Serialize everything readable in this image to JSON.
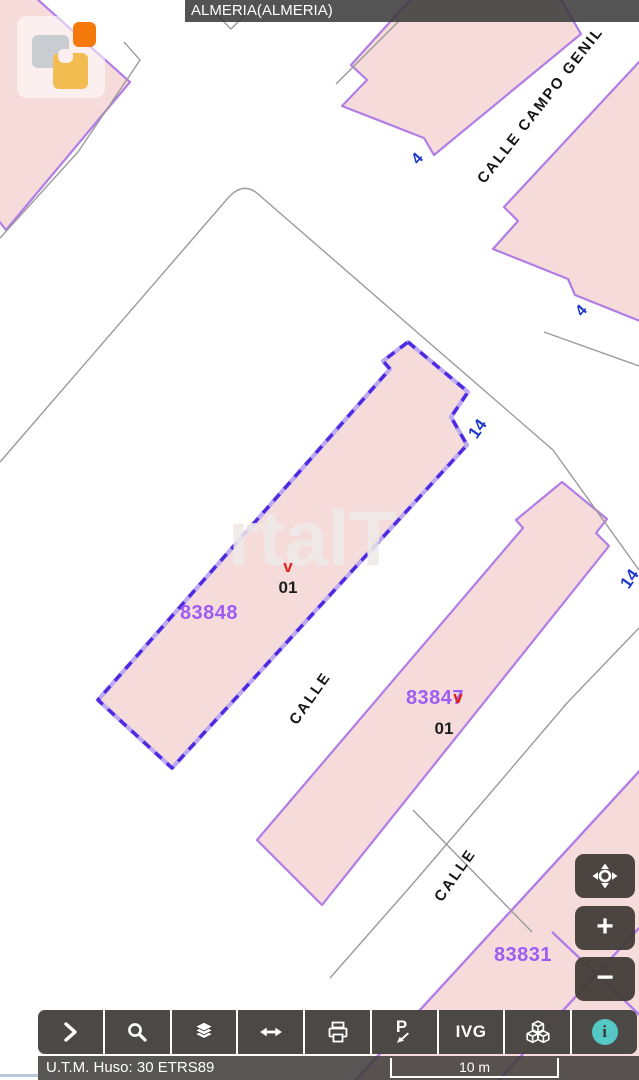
{
  "title_bar": {
    "text": "ALMERIA(ALMERIA)"
  },
  "map": {
    "watermark": "rtalT",
    "selected_parcel": "83848",
    "parcels": {
      "a": "83848",
      "b": "83847",
      "c": "83831"
    },
    "units": {
      "a": "01",
      "b": "01"
    },
    "marks": {
      "a": "v",
      "b": "v"
    },
    "numbers": {
      "n4a": "4",
      "n4b": "4",
      "n14a": "14",
      "n14b": "14"
    },
    "streets": {
      "campo_genil": "CALLE CAMPO GENIL",
      "calle_a": "CALLE",
      "calle_b": "CALLE"
    }
  },
  "map_controls": {
    "zoom_in_glyph": "+",
    "zoom_out_glyph": "−",
    "icons": [
      "locate-icon",
      "zoom-in-icon",
      "zoom-out-icon"
    ]
  },
  "toolbar": {
    "ivg_label": "IVG",
    "p_glyph": "P",
    "info_glyph": "i",
    "items": [
      "expand",
      "search",
      "layers",
      "extent",
      "print",
      "point-info",
      "ivg",
      "model-3d",
      "info"
    ]
  },
  "status_bar": {
    "utm_text": "U.T.M. Huso: 30 ETRS89",
    "scale_label": "10 m"
  },
  "colors": {
    "parcel_fill": "#f5dcdb",
    "parcel_border": "#b27ce6",
    "selected_border": "#4c2ae2",
    "parcel_label": "#9e5df2",
    "house_number_blue": "#2038cc",
    "red_mark": "#e02020",
    "ui_dark": "#3c3c3c",
    "info_teal": "#55c7c5",
    "logo_orange": "#f5790a",
    "logo_amber": "#f3bc51",
    "logo_gray": "#c9ccd0"
  }
}
